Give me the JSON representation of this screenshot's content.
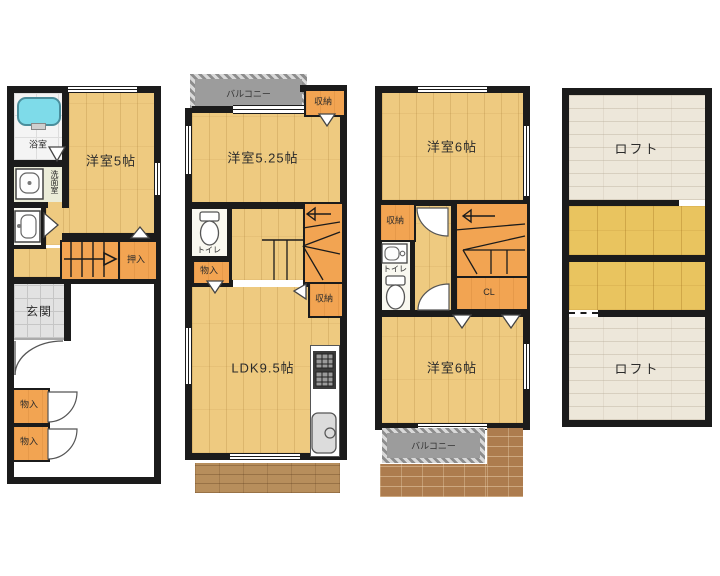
{
  "f1": {
    "bath": "浴室",
    "wash": "洗面室",
    "room": "洋室5帖",
    "oshiire": "押入",
    "genkan": "玄関",
    "mono1": "物入",
    "mono2": "物入"
  },
  "f2": {
    "balcony": "バルコニー",
    "closet_top": "収納",
    "room": "洋室5.25帖",
    "toilet": "トイレ",
    "mono": "物入",
    "closet_mid": "収納",
    "ldk": "LDK9.5帖"
  },
  "f3": {
    "room_top": "洋室6帖",
    "closet": "収納",
    "toilet": "トイレ",
    "cl": "CL",
    "room_bottom": "洋室6帖",
    "balcony": "バルコニー"
  },
  "loft": {
    "top": "ロフト",
    "bottom": "ロフト"
  },
  "colors": {
    "wall": "#1b1b1b",
    "wood_floor": "#eeca80",
    "loft_wood": "#e9c45f",
    "loft_ceiling": "#ede7da",
    "storage_orange": "#f2a452",
    "balcony_gray": "#9c9c9c",
    "deck_brown": "#b78e5c",
    "brick_brown": "#ad7c4e",
    "tub_cyan": "#7edbe9",
    "genkan_tile": "#e2e2e2"
  },
  "icons": {
    "bathtub": "bathtub-icon",
    "washbasin": "washbasin-icon",
    "toilet": "toilet-icon",
    "stairs_up": "stairs-arrow-icon",
    "stove": "stove-icon",
    "kitchen_sink": "kitchen-sink-icon",
    "door_swing": "door-arc-icon",
    "door_triangle": "door-triangle-icon"
  }
}
